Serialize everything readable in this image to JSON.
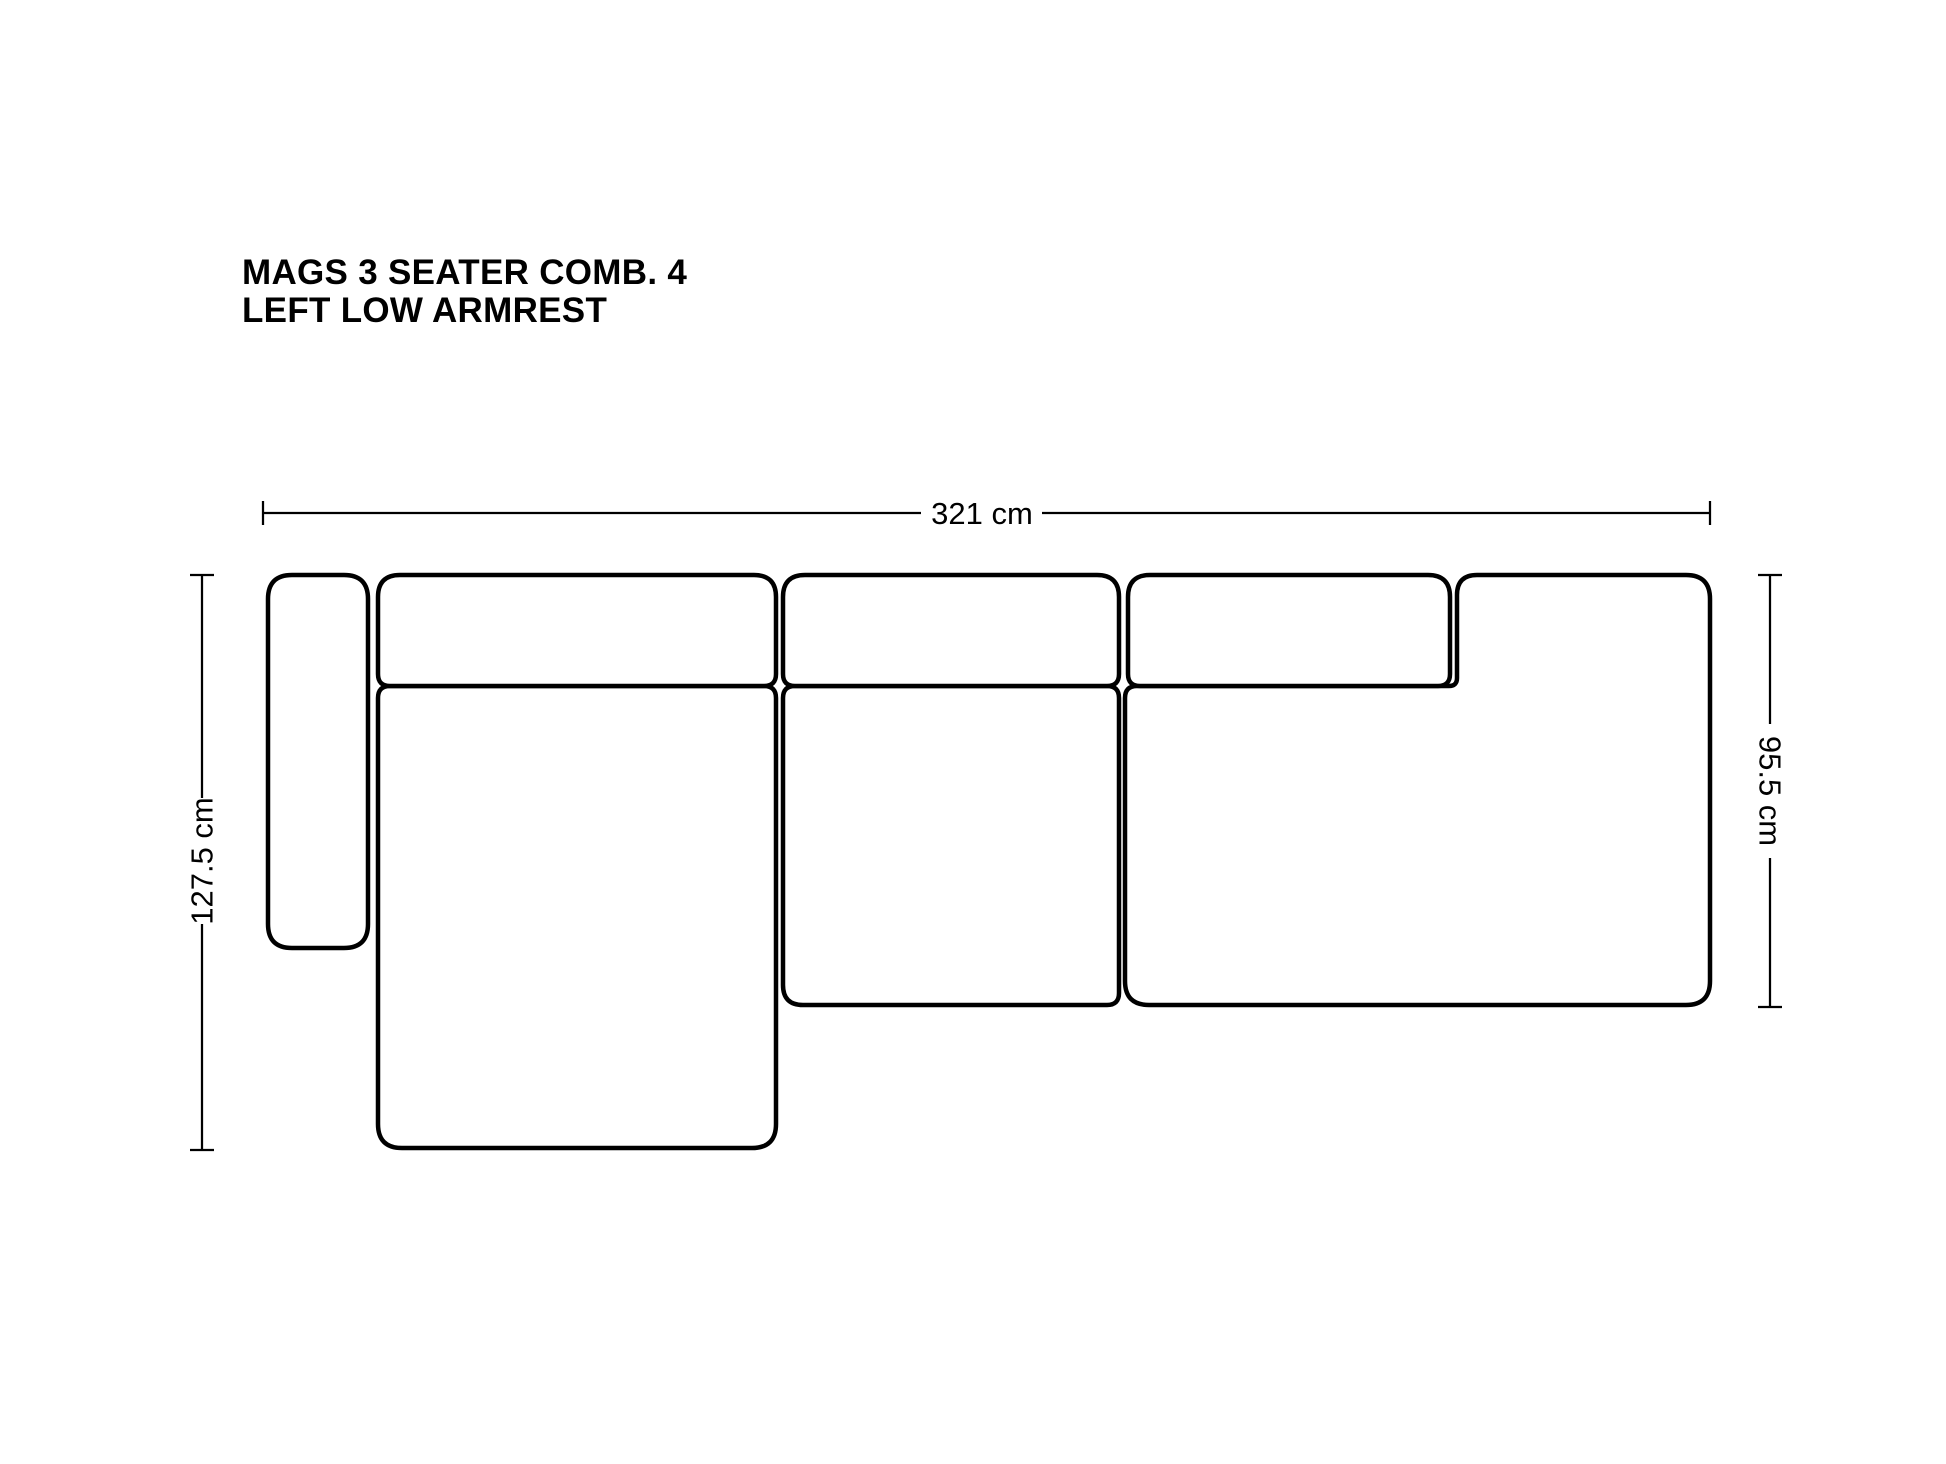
{
  "title": {
    "line1": "MAGS 3 SEATER COMB. 4",
    "line2": "LEFT LOW ARMREST"
  },
  "dimensions": {
    "overall_width": "321 cm",
    "chaise_depth": "127.5 cm",
    "sofa_depth": "95.5 cm"
  },
  "colors": {
    "line": "#000000",
    "background": "#ffffff"
  }
}
